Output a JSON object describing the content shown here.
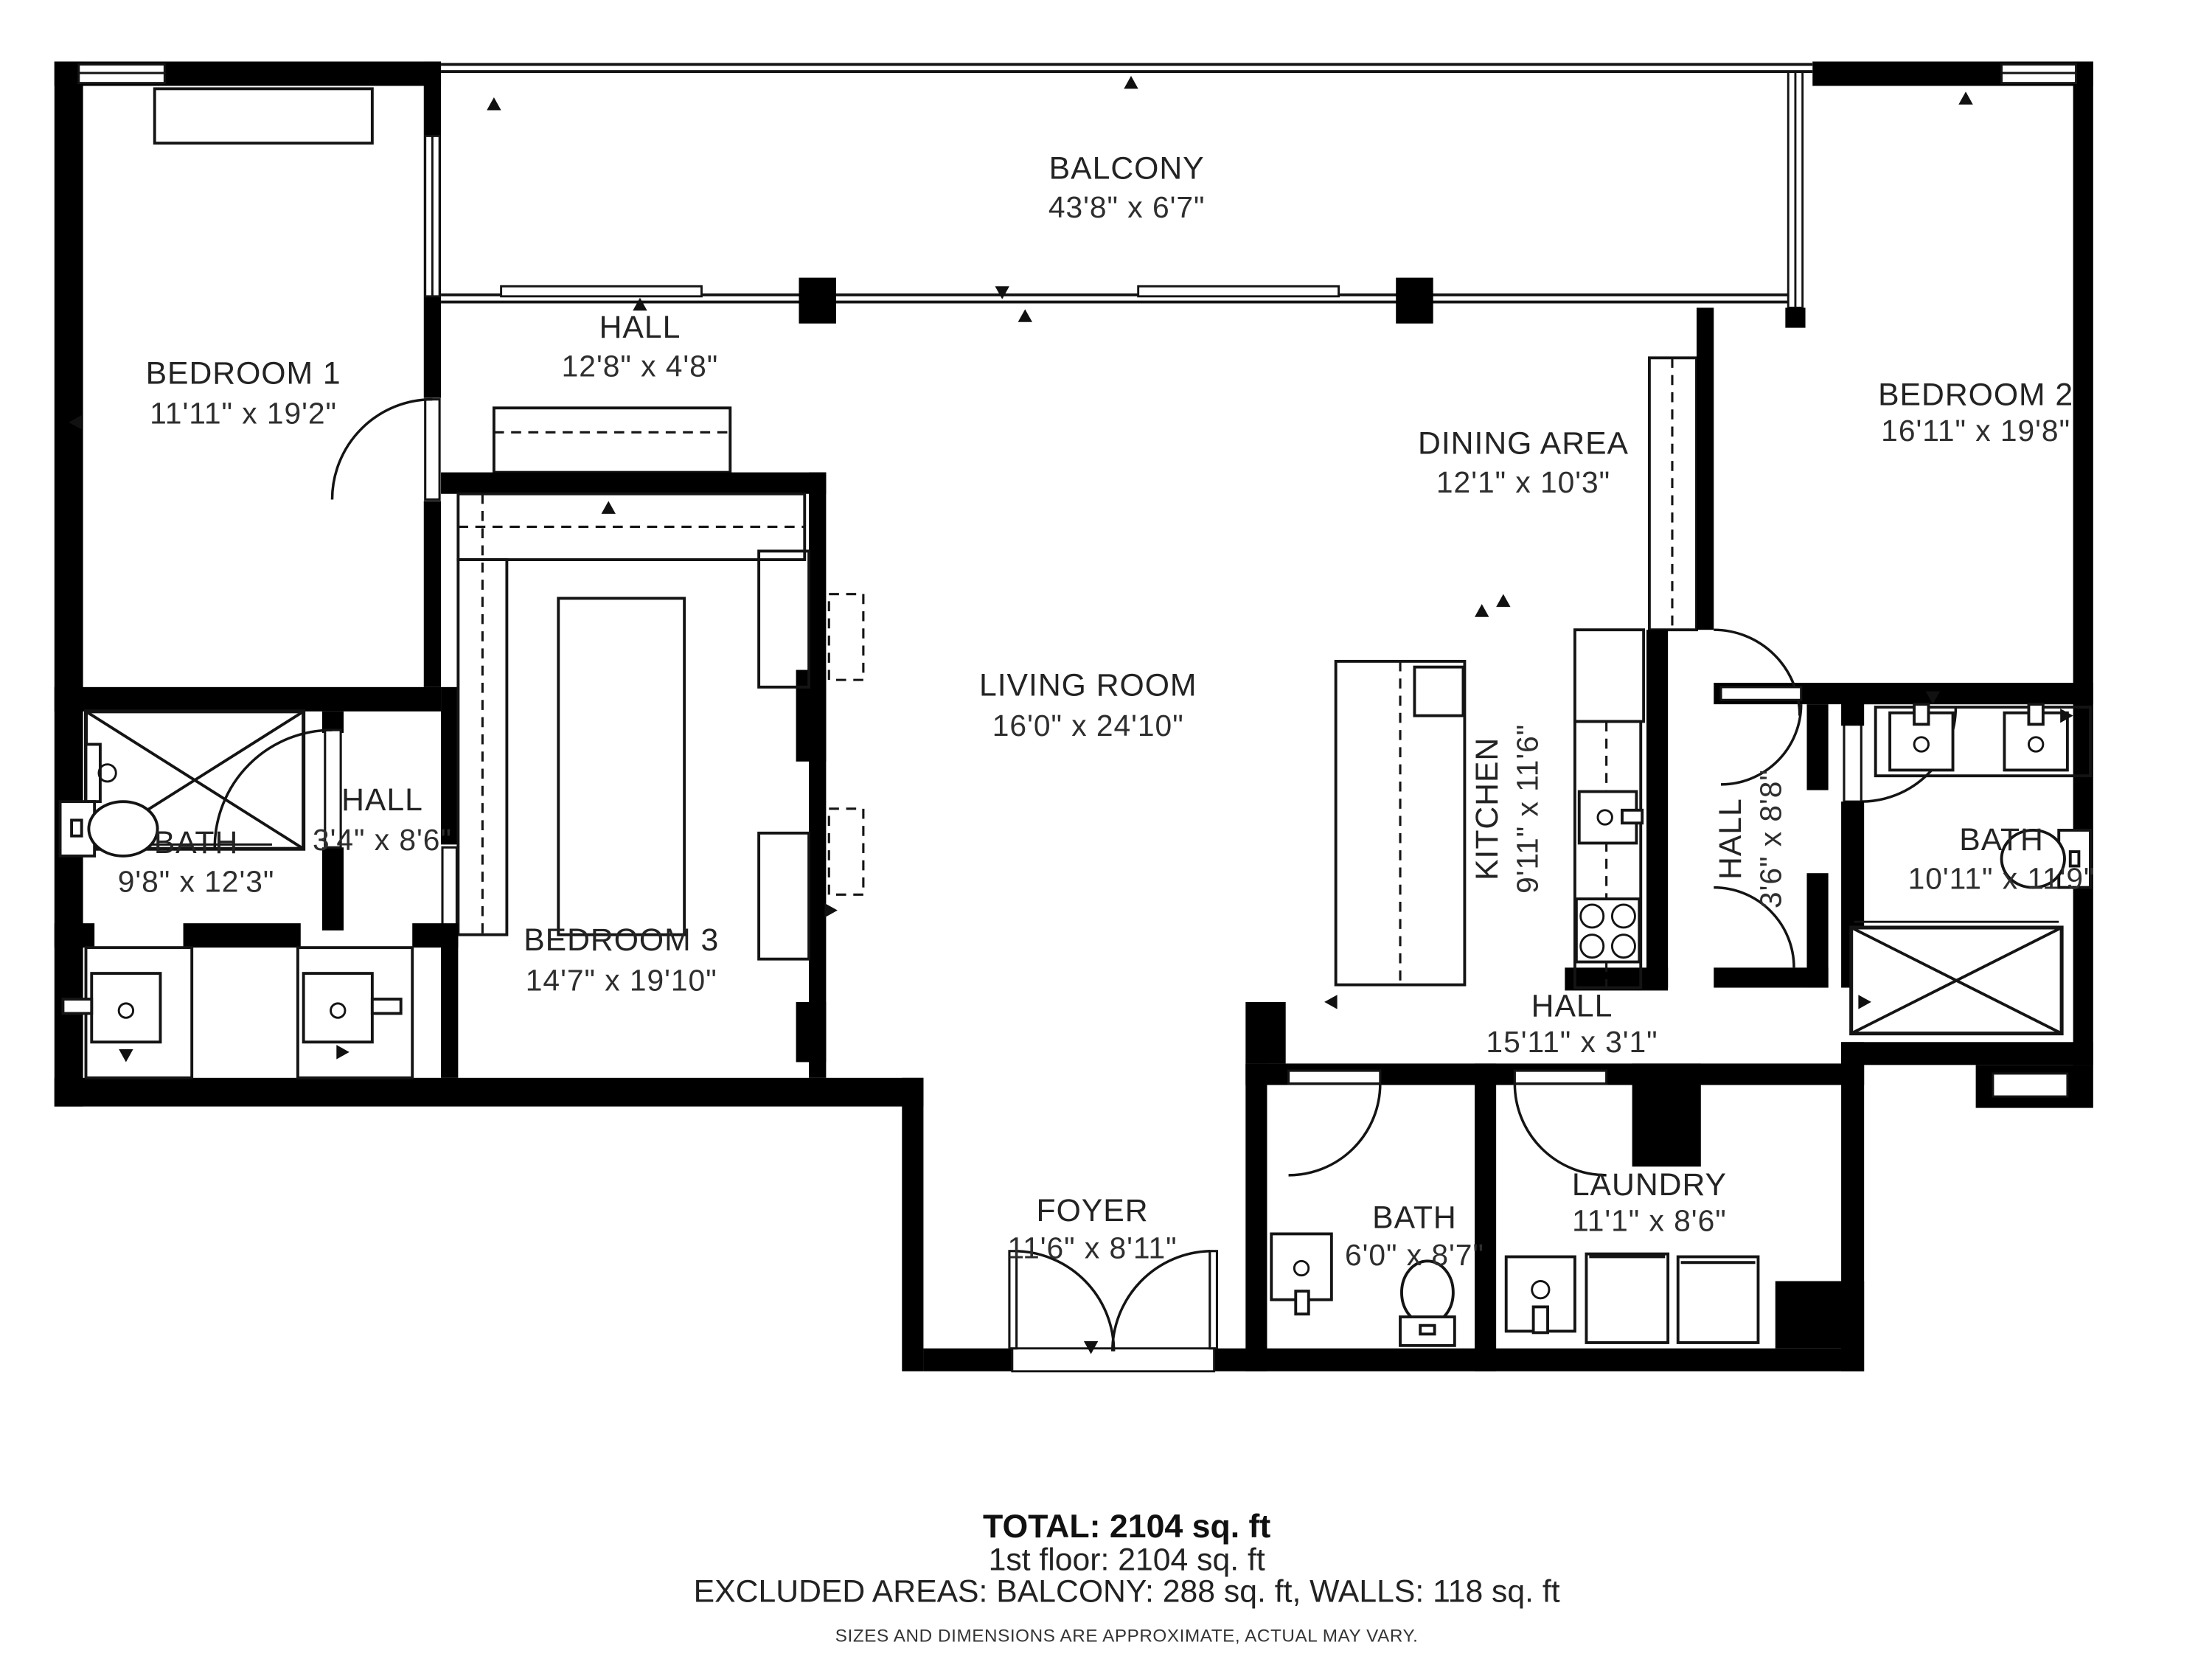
{
  "rooms": [
    {
      "name": "BALCONY",
      "dims": "43'8\" x 6'7\""
    },
    {
      "name": "BEDROOM 1",
      "dims": "11'11\" x 19'2\""
    },
    {
      "name": "HALL",
      "dims": "12'8\" x 4'8\""
    },
    {
      "name": "DINING AREA",
      "dims": "12'1\" x 10'3\""
    },
    {
      "name": "BEDROOM 2",
      "dims": "16'11\" x 19'8\""
    },
    {
      "name": "BATH",
      "dims": "9'8\" x 12'3\""
    },
    {
      "name": "HALL",
      "dims": "3'4\" x 8'6\""
    },
    {
      "name": "BEDROOM 3",
      "dims": "14'7\" x 19'10\""
    },
    {
      "name": "LIVING ROOM",
      "dims": "16'0\" x 24'10\""
    },
    {
      "name": "KITCHEN",
      "dims": "9'11\" x 11'6\""
    },
    {
      "name": "HALL",
      "dims": "3'6\" x 8'8\""
    },
    {
      "name": "BATH",
      "dims": "10'11\" x 11'9\""
    },
    {
      "name": "HALL",
      "dims": "15'11\" x 3'1\""
    },
    {
      "name": "FOYER",
      "dims": "11'6\" x 8'11\""
    },
    {
      "name": "BATH",
      "dims": "6'0\" x 8'7\""
    },
    {
      "name": "LAUNDRY",
      "dims": "11'1\" x 8'6\""
    }
  ],
  "summary": {
    "total": "TOTAL: 2104 sq. ft",
    "floor": "1st floor: 2104 sq. ft",
    "excluded": "EXCLUDED AREAS: BALCONY: 288 sq. ft, WALLS: 118 sq. ft",
    "disclaimer": "SIZES AND DIMENSIONS ARE APPROXIMATE, ACTUAL MAY VARY."
  }
}
